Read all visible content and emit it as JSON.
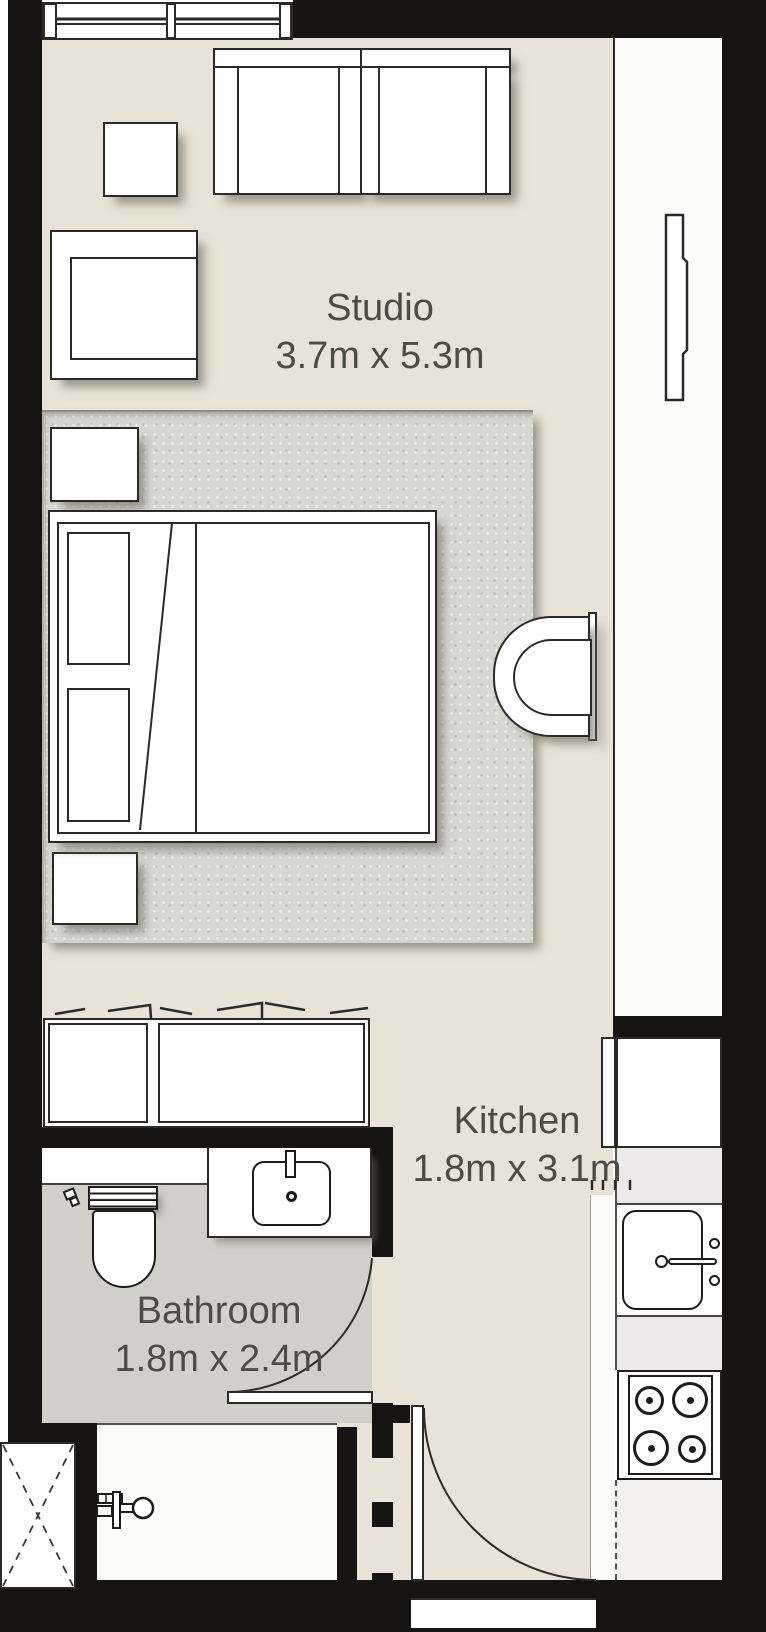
{
  "plan_title": "Studio apartment floor plan",
  "rooms": [
    {
      "id": "studio",
      "label": "Studio",
      "dimensions": "3.7m x 5.3m"
    },
    {
      "id": "kitchen",
      "label": "Kitchen",
      "dimensions": "1.8m x 3.1m"
    },
    {
      "id": "bathroom",
      "label": "Bathroom",
      "dimensions": "1.8m x 2.4m"
    }
  ],
  "colors": {
    "wall": "#151413",
    "floor": "#e8e3d6",
    "rug": "#d7d8d1",
    "bathroom_floor": "#d1d0c8",
    "kitchen_floor": "#fbfbfa",
    "counter": "#ebe9e9",
    "line": "#2b2a28",
    "label_text": "#4d4b44"
  }
}
